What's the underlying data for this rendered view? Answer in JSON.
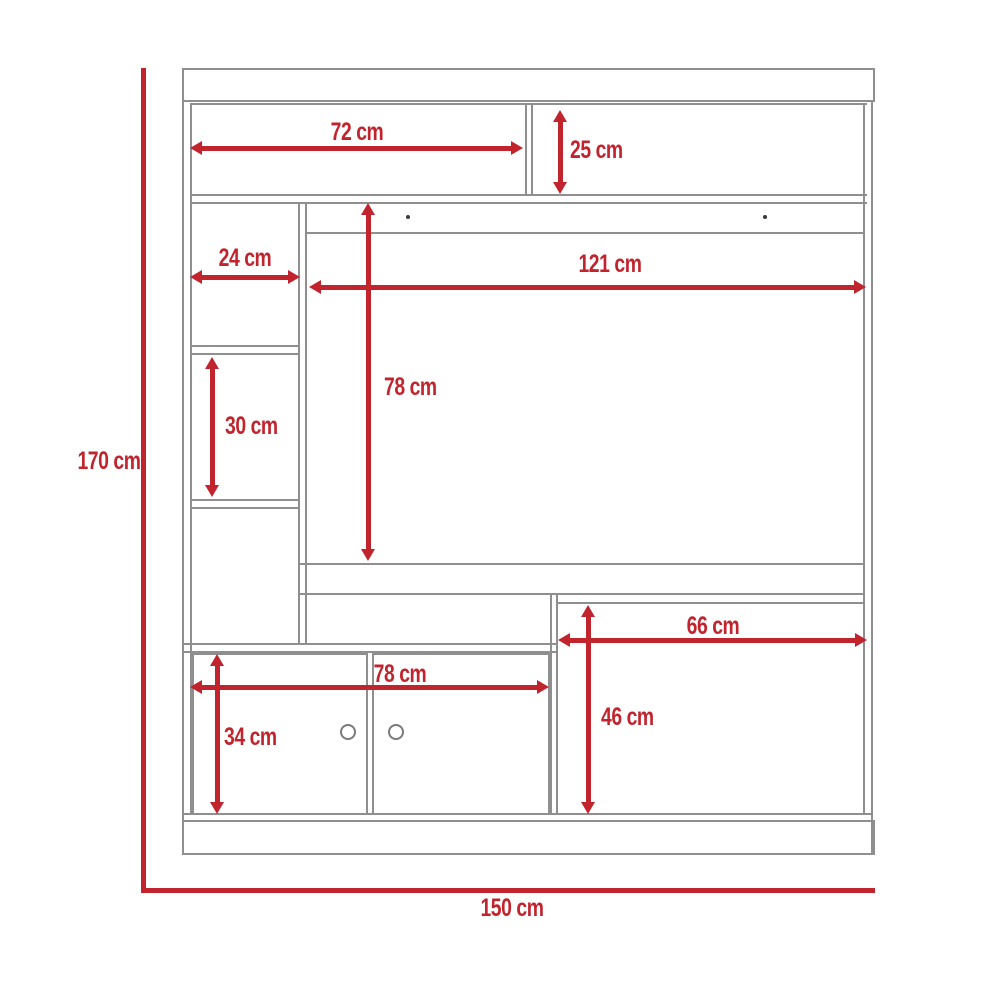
{
  "diagram": {
    "type": "furniture-dimension-drawing",
    "subject": "entertainment-center",
    "unit": "cm",
    "colors": {
      "dimension_red": "#C2242E",
      "outline_gray": "#8F8F8F",
      "background": "#FFFFFF"
    },
    "labels": {
      "overall_height": "170 cm",
      "overall_width": "150 cm",
      "top_shelf_width": "72 cm",
      "top_right_shelf_height": "25 cm",
      "side_column_width": "24 cm",
      "tv_opening_width": "121 cm",
      "tv_opening_height": "78 cm",
      "side_compartment_height": "30 cm",
      "cabinet_width": "78 cm",
      "cabinet_height": "34 cm",
      "right_compartment_width": "66 cm",
      "right_compartment_height": "46 cm"
    }
  }
}
